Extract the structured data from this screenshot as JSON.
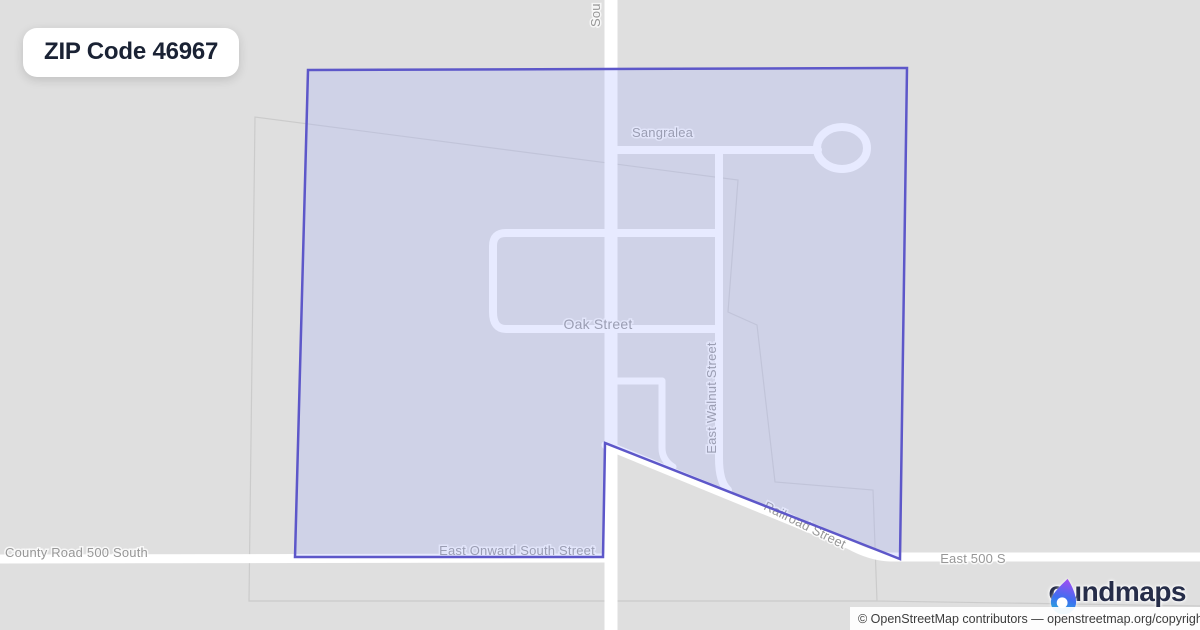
{
  "badge": {
    "label": "ZIP Code 46967"
  },
  "map": {
    "background_color": "#dfdfdf",
    "road_color": "#ffffff",
    "boundary_stroke": "#5d57c9",
    "boundary_fill": "rgba(168,176,255,0.27)",
    "labels": {
      "south_main": "Sou",
      "sangralea": "Sangralea",
      "oak_street": "Oak Street",
      "east_walnut": "East Walnut Street",
      "railroad": "Railroad Street",
      "east_onward": "East Onward South Street",
      "county_road_500": "County Road 500 South",
      "east_500_s": "East 500 S"
    }
  },
  "logo": {
    "name": "boundmaps",
    "wordmark_rest": "oundmaps",
    "colors": {
      "purple": "#a14df2",
      "blue": "#3e6ef0",
      "teal": "#24b1d8"
    }
  },
  "attribution": {
    "text": "© OpenStreetMap contributors — openstreetmap.org/copyright"
  }
}
